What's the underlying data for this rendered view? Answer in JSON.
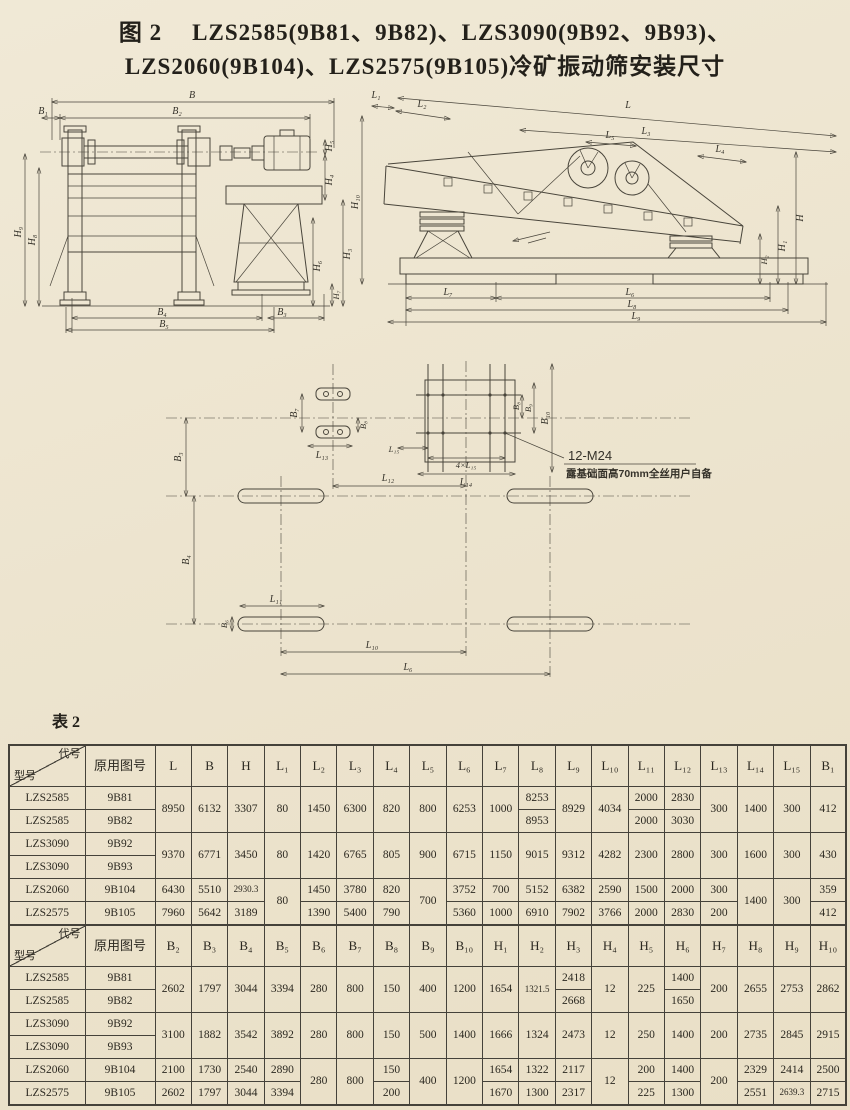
{
  "title": {
    "figure_no": "图 2",
    "line1": "LZS2585(9B81、9B82)、LZS3090(9B92、9B93)、",
    "line2": "LZS2060(9B104)、LZS2575(9B105)冷矿振动筛安装尺寸"
  },
  "table_label": "表 2",
  "annotations": {
    "anchor_spec": "12-M24",
    "anchor_note": "露基础面高70mm全丝用户自备"
  },
  "dims": {
    "B": "B",
    "B1": "B₁",
    "B2": "B₂",
    "B3": "B₃",
    "B4": "B₄",
    "B5": "B₅",
    "B6": "B₆",
    "B7": "B₇",
    "B8": "B₈",
    "B9": "B₉",
    "B10": "B₁₀",
    "H": "H",
    "H1": "H₁",
    "H2": "H₂",
    "H3": "H₃",
    "H4": "H₄",
    "H5": "H₅",
    "H6": "H₆",
    "H7": "H₇",
    "H8": "H₈",
    "H9": "H₉",
    "H10": "H₁₀",
    "L": "L",
    "L1": "L₁",
    "L2": "L₂",
    "L3": "L₃",
    "L4": "L₄",
    "L5": "L₅",
    "L6": "L₆",
    "L7": "L₇",
    "L8": "L₈",
    "L9": "L₉",
    "L10": "L₁₀",
    "L11": "L₁₁",
    "L12": "L₁₂",
    "L13": "L₁₃",
    "L14": "L₁₄",
    "L15": "L₁₅",
    "L4x15": "4×L₁₅"
  },
  "table": {
    "sections": [
      {
        "corner_top": "代号",
        "corner_bottom": "型号",
        "col2": "原用图号",
        "cols": [
          "L",
          "B",
          "H",
          "L₁",
          "L₂",
          "L₃",
          "L₄",
          "L₅",
          "L₆",
          "L₇",
          "L₈",
          "L₉",
          "L₁₀",
          "L₁₁",
          "L₁₂",
          "L₁₃",
          "L₁₄",
          "L₁₅",
          "B₁"
        ],
        "rows": [
          [
            "LZS2585",
            "9B81",
            {
              "t": "8950",
              "rs": 2
            },
            {
              "t": "6132",
              "rs": 2
            },
            {
              "t": "3307",
              "rs": 2
            },
            {
              "t": "80",
              "rs": 2
            },
            {
              "t": "1450",
              "rs": 2
            },
            {
              "t": "6300",
              "rs": 2
            },
            {
              "t": "820",
              "rs": 2
            },
            {
              "t": "800",
              "rs": 2
            },
            {
              "t": "6253",
              "rs": 2
            },
            {
              "t": "1000",
              "rs": 2
            },
            "8253",
            {
              "t": "8929",
              "rs": 2
            },
            {
              "t": "4034",
              "rs": 2
            },
            "2000",
            "2830",
            {
              "t": "300",
              "rs": 2
            },
            {
              "t": "1400",
              "rs": 2
            },
            {
              "t": "300",
              "rs": 2
            },
            {
              "t": "412",
              "rs": 2
            }
          ],
          [
            "LZS2585",
            "9B82",
            "8953",
            "2000",
            "3030"
          ],
          [
            "LZS3090",
            "9B92",
            {
              "t": "9370",
              "rs": 2
            },
            {
              "t": "6771",
              "rs": 2
            },
            {
              "t": "3450",
              "rs": 2
            },
            {
              "t": "80",
              "rs": 2
            },
            {
              "t": "1420",
              "rs": 2
            },
            {
              "t": "6765",
              "rs": 2
            },
            {
              "t": "805",
              "rs": 2
            },
            {
              "t": "900",
              "rs": 2
            },
            {
              "t": "6715",
              "rs": 2
            },
            {
              "t": "1150",
              "rs": 2
            },
            {
              "t": "9015",
              "rs": 2
            },
            {
              "t": "9312",
              "rs": 2
            },
            {
              "t": "4282",
              "rs": 2
            },
            {
              "t": "2300",
              "rs": 2
            },
            {
              "t": "2800",
              "rs": 2
            },
            {
              "t": "300",
              "rs": 2
            },
            {
              "t": "1600",
              "rs": 2
            },
            {
              "t": "300",
              "rs": 2
            },
            {
              "t": "430",
              "rs": 2
            }
          ],
          [
            "LZS3090",
            "9B93"
          ],
          [
            "LZS2060",
            "9B104",
            "6430",
            "5510",
            {
              "t": "2930.3",
              "sm": 1
            },
            {
              "t": "80",
              "rs": 2
            },
            "1450",
            "3780",
            "820",
            {
              "t": "700",
              "rs": 2
            },
            "3752",
            "700",
            "5152",
            "6382",
            "2590",
            "1500",
            "2000",
            "300",
            {
              "t": "1400",
              "rs": 2
            },
            {
              "t": "300",
              "rs": 2
            },
            "359"
          ],
          [
            "LZS2575",
            "9B105",
            "7960",
            "5642",
            "3189",
            "1390",
            "5400",
            "790",
            "5360",
            "1000",
            "6910",
            "7902",
            "3766",
            "2000",
            "2830",
            "200",
            "412"
          ]
        ]
      },
      {
        "corner_top": "代号",
        "corner_bottom": "型号",
        "col2": "原用图号",
        "cols": [
          "B₂",
          "B₃",
          "B₄",
          "B₅",
          "B₆",
          "B₇",
          "B₈",
          "B₉",
          "B₁₀",
          "H₁",
          "H₂",
          "H₃",
          "H₄",
          "H₅",
          "H₆",
          "H₇",
          "H₈",
          "H₉",
          "H₁₀"
        ],
        "rows": [
          [
            "LZS2585",
            "9B81",
            {
              "t": "2602",
              "rs": 2
            },
            {
              "t": "1797",
              "rs": 2
            },
            {
              "t": "3044",
              "rs": 2
            },
            {
              "t": "3394",
              "rs": 2
            },
            {
              "t": "280",
              "rs": 2
            },
            {
              "t": "800",
              "rs": 2
            },
            {
              "t": "150",
              "rs": 2
            },
            {
              "t": "400",
              "rs": 2
            },
            {
              "t": "1200",
              "rs": 2
            },
            {
              "t": "1654",
              "rs": 2
            },
            {
              "t": "1321.5",
              "rs": 2,
              "sm": 1
            },
            "2418",
            {
              "t": "12",
              "rs": 2
            },
            {
              "t": "225",
              "rs": 2
            },
            "1400",
            {
              "t": "200",
              "rs": 2
            },
            {
              "t": "2655",
              "rs": 2
            },
            {
              "t": "2753",
              "rs": 2
            },
            {
              "t": "2862",
              "rs": 2
            }
          ],
          [
            "LZS2585",
            "9B82",
            "2668",
            "1650"
          ],
          [
            "LZS3090",
            "9B92",
            {
              "t": "3100",
              "rs": 2
            },
            {
              "t": "1882",
              "rs": 2
            },
            {
              "t": "3542",
              "rs": 2
            },
            {
              "t": "3892",
              "rs": 2
            },
            {
              "t": "280",
              "rs": 2
            },
            {
              "t": "800",
              "rs": 2
            },
            {
              "t": "150",
              "rs": 2
            },
            {
              "t": "500",
              "rs": 2
            },
            {
              "t": "1400",
              "rs": 2
            },
            {
              "t": "1666",
              "rs": 2
            },
            {
              "t": "1324",
              "rs": 2
            },
            {
              "t": "2473",
              "rs": 2
            },
            {
              "t": "12",
              "rs": 2
            },
            {
              "t": "250",
              "rs": 2
            },
            {
              "t": "1400",
              "rs": 2
            },
            {
              "t": "200",
              "rs": 2
            },
            {
              "t": "2735",
              "rs": 2
            },
            {
              "t": "2845",
              "rs": 2
            },
            {
              "t": "2915",
              "rs": 2
            }
          ],
          [
            "LZS3090",
            "9B93"
          ],
          [
            "LZS2060",
            "9B104",
            "2100",
            "1730",
            "2540",
            "2890",
            {
              "t": "280",
              "rs": 2
            },
            {
              "t": "800",
              "rs": 2
            },
            "150",
            {
              "t": "400",
              "rs": 2
            },
            {
              "t": "1200",
              "rs": 2
            },
            "1654",
            "1322",
            "2117",
            {
              "t": "12",
              "rs": 2
            },
            "200",
            "1400",
            {
              "t": "200",
              "rs": 2
            },
            "2329",
            "2414",
            "2500"
          ],
          [
            "LZS2575",
            "9B105",
            "2602",
            "1797",
            "3044",
            "3394",
            "200",
            "1670",
            "1300",
            "2317",
            "225",
            "1300",
            "2551",
            {
              "t": "2639.3",
              "sm": 1
            },
            "2715"
          ]
        ]
      }
    ]
  }
}
